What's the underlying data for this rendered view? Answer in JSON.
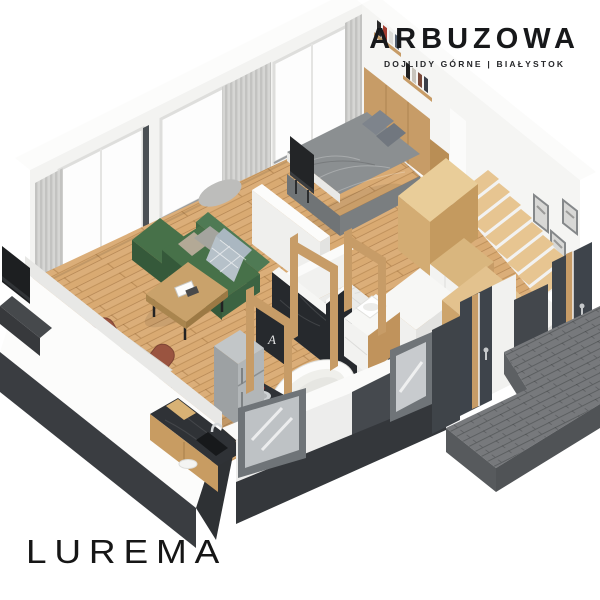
{
  "branding": {
    "project_name": "ARBUZOWA",
    "location_line": "DOJLIDY GÓRNE  |  BIAŁYSTOK",
    "studio_logo": "LUREMA"
  },
  "scene": {
    "type": "isometric-apartment-render",
    "decor_letter": "A",
    "rooms": [
      "living-room",
      "dining-area",
      "kitchen",
      "bathroom",
      "bedroom",
      "hallway",
      "staircase",
      "entrance"
    ]
  },
  "palette": {
    "wood-floor": "#d9aa72",
    "wood-stair": "#e7c591",
    "wood-furniture": "#c79c67",
    "wall-white": "#f4f4f2",
    "wall-top": "#fbfbfa",
    "wall-outer": "#c6c7c8",
    "plinth": "#3a3d41",
    "anthracite": "#3e444b",
    "sofa-green": "#477149",
    "sofa-green-dark": "#35593a",
    "chair-rust": "#9a5440",
    "bed-gray": "#8b8f91",
    "curtain": "#d6d6d4",
    "counter-dark": "#2f3236",
    "marble-light": "#ebebe9",
    "marble-dark": "#26292d",
    "steps-gray": "#77797c",
    "tub-white": "#fcfcfb",
    "frame-gray": "#6f7478",
    "plate-gold": "#d9b97e",
    "plant-green": "#3f9b44"
  }
}
